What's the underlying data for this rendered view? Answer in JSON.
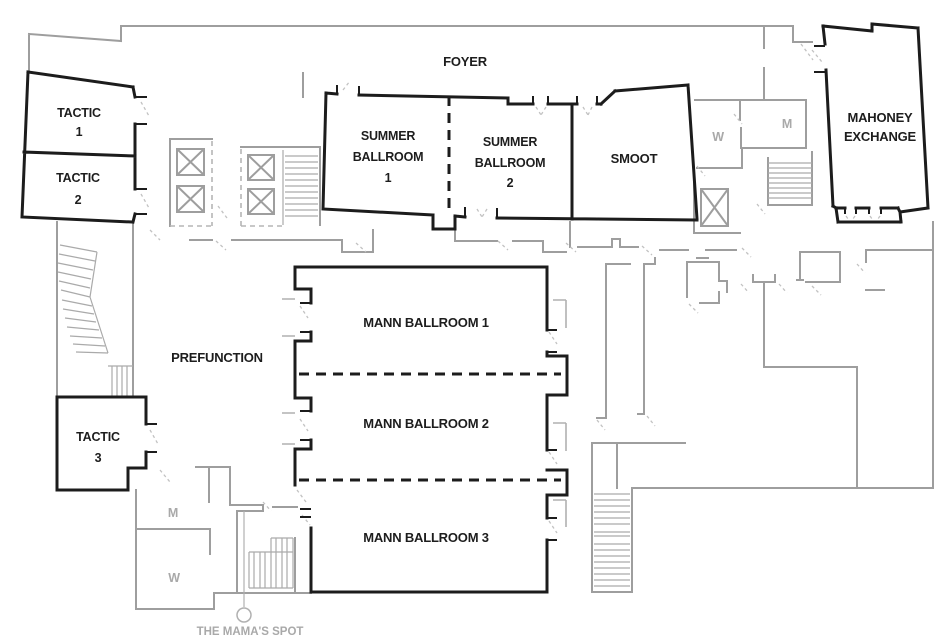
{
  "title": "Conference level floor plan",
  "rooms": {
    "foyer": {
      "label": "FOYER"
    },
    "prefunction": {
      "label": "PREFUNCTION"
    },
    "tactic_1": {
      "line1": "TACTIC",
      "line2": "1"
    },
    "tactic_2": {
      "line1": "TACTIC",
      "line2": "2"
    },
    "tactic_3": {
      "line1": "TACTIC",
      "line2": "3"
    },
    "summer_ballroom_1": {
      "line1": "SUMMER",
      "line2": "BALLROOM",
      "line3": "1"
    },
    "summer_ballroom_2": {
      "line1": "SUMMER",
      "line2": "BALLROOM",
      "line3": "2"
    },
    "smoot": {
      "label": "SMOOT"
    },
    "mahoney_exchange": {
      "line1": "MAHONEY",
      "line2": "EXCHANGE"
    },
    "mann_ballroom_1": {
      "label": "MANN BALLROOM 1"
    },
    "mann_ballroom_2": {
      "label": "MANN BALLROOM 2"
    },
    "mann_ballroom_3": {
      "label": "MANN BALLROOM 3"
    }
  },
  "facilities": {
    "mens_upper": "M",
    "womens_upper": "W",
    "mens_lower": "M",
    "womens_lower": "W"
  },
  "callout": {
    "label": "THE MAMA'S SPOT"
  },
  "colors": {
    "wall_black": "#1c1c1c",
    "wall_gray": "#9e9e9e",
    "door_dash": "#c2c2c2",
    "label_gray": "#a9a9a9",
    "text": "#1d1d1d"
  }
}
